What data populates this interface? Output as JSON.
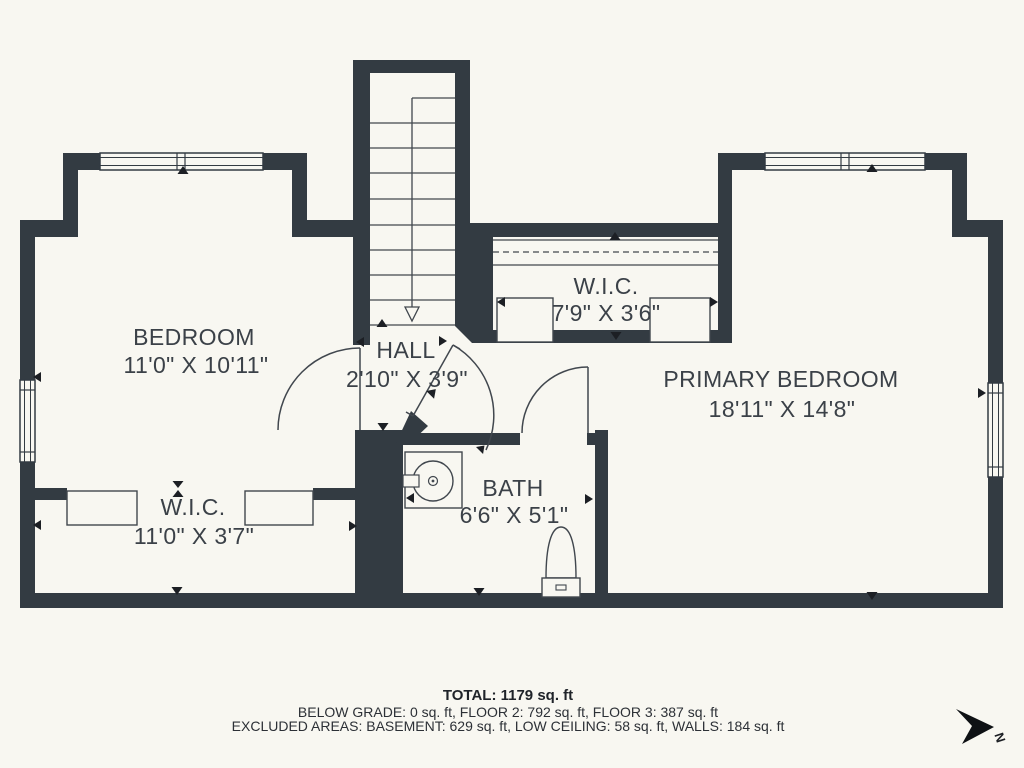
{
  "plan": {
    "type": "floor-plan",
    "rooms": {
      "bedroom": {
        "name": "BEDROOM",
        "dims": "11'0\" X 10'11\""
      },
      "hall": {
        "name": "HALL",
        "dims": "2'10\" X 3'9\""
      },
      "wic_right": {
        "name": "W.I.C.",
        "dims": "7'9\" X 3'6\""
      },
      "primary_bedroom": {
        "name": "PRIMARY BEDROOM",
        "dims": "18'11\" X 14'8\""
      },
      "wic_left": {
        "name": "W.I.C.",
        "dims": "11'0\" X 3'7\""
      },
      "bath": {
        "name": "BATH",
        "dims": "6'6\" X 5'1\""
      }
    },
    "fixtures": [
      "staircase",
      "sink",
      "toilet",
      "closet-shelves",
      "closet-rod"
    ],
    "colors": {
      "wall": "#333b42",
      "background": "#f8f7f1",
      "text": "#3b4148",
      "fixture_line": "#41474e"
    }
  },
  "footer": {
    "total": "TOTAL: 1179 sq. ft",
    "line2": "BELOW GRADE: 0 sq. ft, FLOOR 2: 792 sq. ft, FLOOR 3: 387 sq. ft",
    "line3": "EXCLUDED AREAS: BASEMENT: 629 sq. ft, LOW CEILING: 58 sq. ft, WALLS: 184 sq. ft"
  },
  "compass": {
    "label": "N"
  }
}
